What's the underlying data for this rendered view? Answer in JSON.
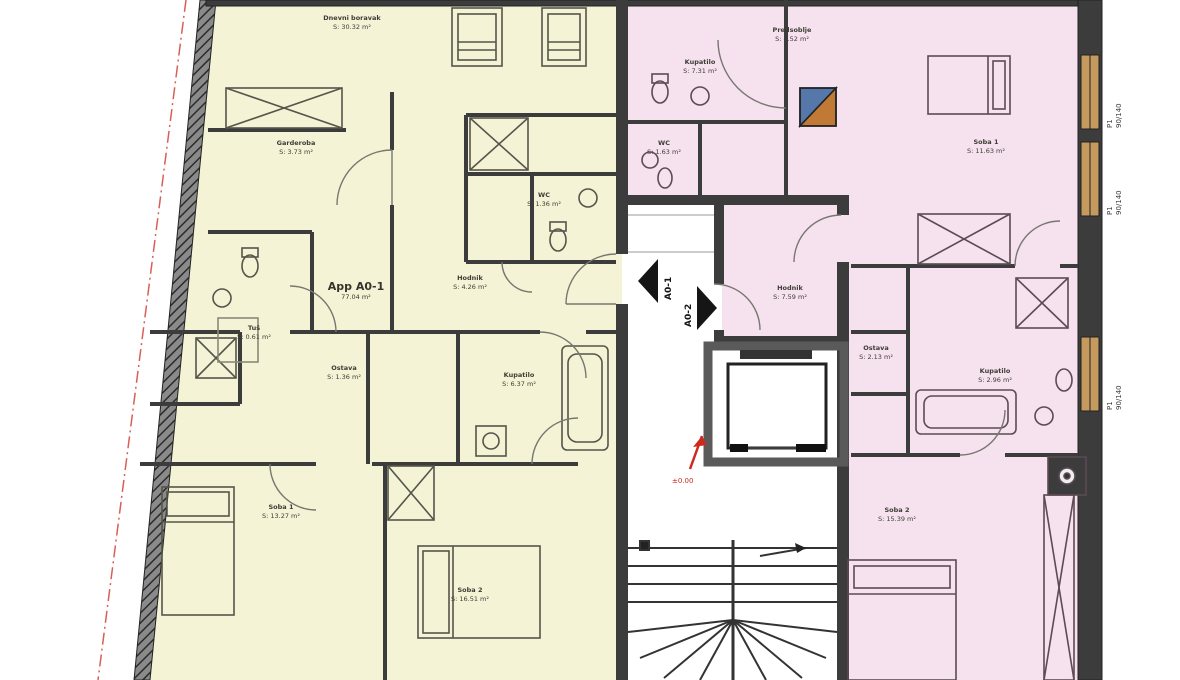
{
  "meta": {
    "type": "architectural floor plan",
    "sheet": "apartment storey plan with stair core"
  },
  "colors": {
    "apt1": "#f5f3d6",
    "apt2": "#f6e1ee",
    "wall": "#3c3c3c",
    "wall-light": "#6a6a6a",
    "window-tan": "#c49a5e",
    "red": "#cc2a1e",
    "shaft-blue": "#5577aa",
    "shaft-orange": "#c07a35",
    "door": "#777770",
    "stair": "#333333"
  },
  "apartments": [
    {
      "id": "A0-1",
      "label": "App A0-1",
      "area_label": "77.04 m²",
      "fill": "#f5f3d6"
    },
    {
      "id": "A0-2",
      "label": "App A0-2",
      "fill": "#f6e1ee"
    }
  ],
  "rooms": [
    {
      "apartment": "A0-1",
      "name": "Dnevni boravak",
      "area": "S: 30.32 m²",
      "x": 352,
      "y": 14
    },
    {
      "apartment": "A0-1",
      "name": "Garderoba",
      "area": "S: 3.73 m²",
      "x": 296,
      "y": 139
    },
    {
      "apartment": "A0-1",
      "name": "WC",
      "area": "S: 1.36 m²",
      "x": 544,
      "y": 191
    },
    {
      "apartment": "A0-1",
      "name": "Hodnik",
      "area": "S: 4.26 m²",
      "x": 470,
      "y": 274
    },
    {
      "apartment": "A0-1",
      "name": "Tuš",
      "area": "S: 0.61 m²",
      "x": 254,
      "y": 324
    },
    {
      "apartment": "A0-1",
      "name": "Ostava",
      "area": "S: 1.36 m²",
      "x": 344,
      "y": 364
    },
    {
      "apartment": "A0-1",
      "name": "Kupatilo",
      "area": "S: 6.37 m²",
      "x": 519,
      "y": 371
    },
    {
      "apartment": "A0-1",
      "name": "Soba 1",
      "area": "S: 13.27 m²",
      "x": 281,
      "y": 503
    },
    {
      "apartment": "A0-1",
      "name": "Soba 2",
      "area": "S: 16.51 m²",
      "x": 470,
      "y": 586
    },
    {
      "apartment": "A0-2",
      "name": "Kupatilo",
      "area": "S: 7.31 m²",
      "x": 700,
      "y": 58
    },
    {
      "apartment": "A0-2",
      "name": "Predsoblje",
      "area": "S: 4.52 m²",
      "x": 792,
      "y": 26
    },
    {
      "apartment": "A0-2",
      "name": "WC",
      "area": "S: 1.63 m²",
      "x": 664,
      "y": 139
    },
    {
      "apartment": "A0-2",
      "name": "Soba 1",
      "area": "S: 11.63 m²",
      "x": 986,
      "y": 138
    },
    {
      "apartment": "A0-2",
      "name": "Hodnik",
      "area": "S: 7.59 m²",
      "x": 790,
      "y": 284
    },
    {
      "apartment": "A0-2",
      "name": "Ostava",
      "area": "S: 2.13 m²",
      "x": 876,
      "y": 344
    },
    {
      "apartment": "A0-2",
      "name": "Kupatilo",
      "area": "S: 2.96 m²",
      "x": 995,
      "y": 367
    },
    {
      "apartment": "A0-2",
      "name": "Soba 2",
      "area": "S: 15.39 m²",
      "x": 897,
      "y": 506
    }
  ],
  "corridor": {
    "arrows": [
      {
        "label": "A0-1",
        "direction": "left"
      },
      {
        "label": "A0-2",
        "direction": "right"
      }
    ],
    "elevation_marker": {
      "text": "±0.00",
      "color": "#cc2a1e"
    }
  },
  "windows": [
    {
      "label": "P1",
      "size": "90/140"
    },
    {
      "label": "P1",
      "size": "90/140"
    },
    {
      "label": "P1",
      "size": "90/140"
    }
  ]
}
